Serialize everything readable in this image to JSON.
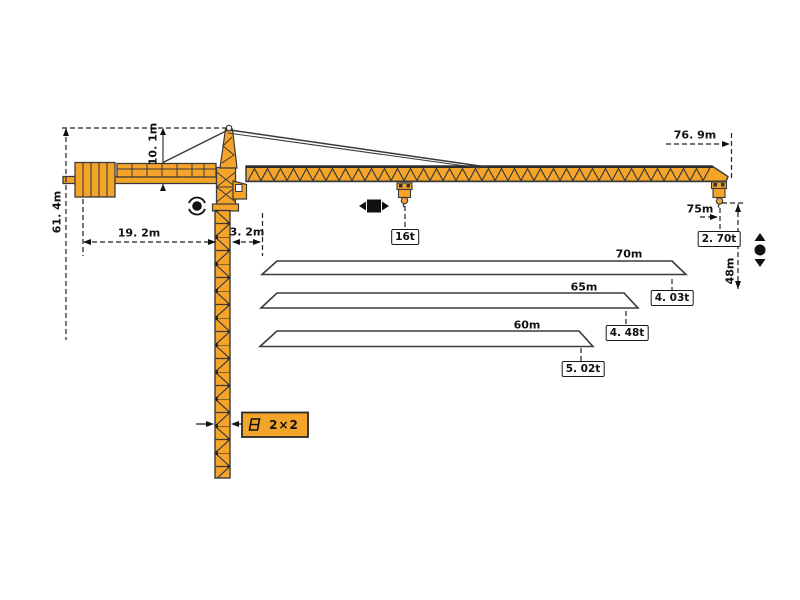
{
  "diagram": {
    "type": "tower-crane-specification-diagram",
    "colors": {
      "crane_fill": "#F5A42A",
      "outline": "#3A3A3A",
      "text": "#111111",
      "background": "#FFFFFF"
    },
    "dimensions": {
      "total_height": "61. 4m",
      "tower_head_height": "10. 1m",
      "counter_jib_length": "19. 2m",
      "jib_root_offset": "3. 2m",
      "tip_distance": "76. 9m",
      "max_working_radius": "75m",
      "hook_height": "48m"
    },
    "capacities": {
      "max_load": "16t",
      "tip_load": "2. 70t"
    },
    "mast": {
      "section_label": "2×2"
    },
    "load_chart": {
      "rows": [
        {
          "jib_length": "70m",
          "tip_capacity": "4. 03t"
        },
        {
          "jib_length": "65m",
          "tip_capacity": "4. 48t"
        },
        {
          "jib_length": "60m",
          "tip_capacity": "5. 02t"
        }
      ]
    },
    "icons": [
      "slewing-icon",
      "trolley-travel-icon",
      "hook-travel-icon",
      "mast-section-icon",
      "hook-icon"
    ]
  }
}
